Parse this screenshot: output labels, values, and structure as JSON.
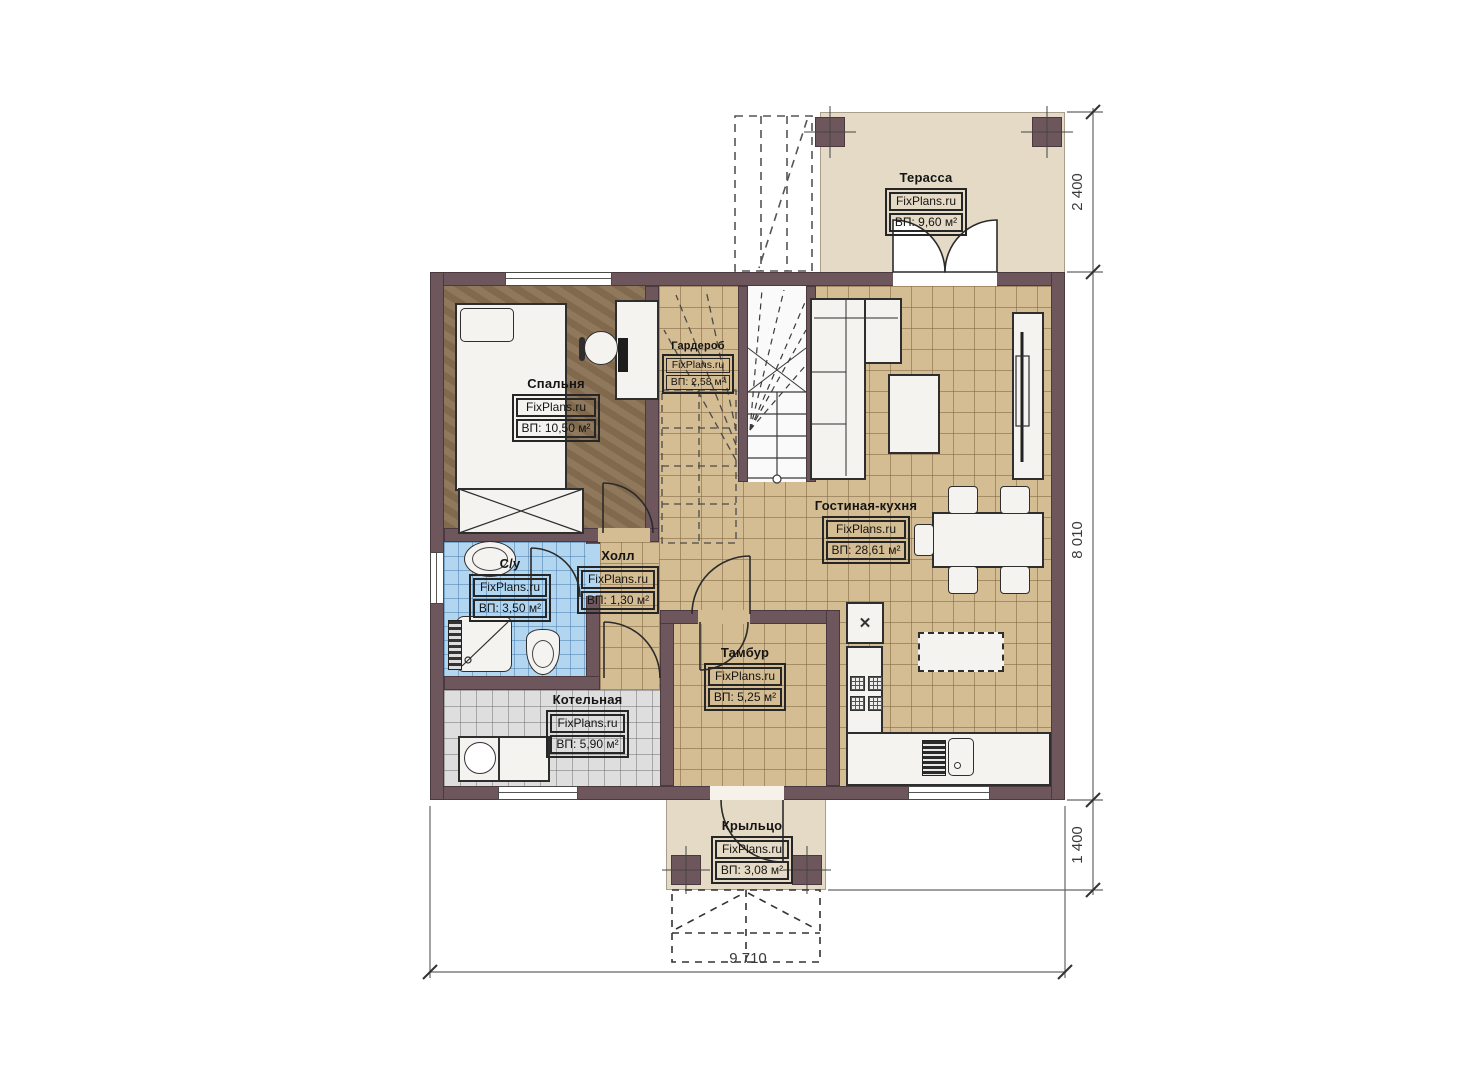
{
  "brand": "FixPlans.ru",
  "icons": {
    "appliance_cross": "✕"
  },
  "rooms": {
    "terrace": {
      "name": "Терасса",
      "area": "ВП: 9,60 м²"
    },
    "bedroom": {
      "name": "Спальня",
      "area": "ВП: 10,50 м²"
    },
    "wardrobe": {
      "name": "Гардероб",
      "area": "ВП: 2,58 м²"
    },
    "living_kitchen": {
      "name": "Гостиная-кухня",
      "area": "ВП: 28,61 м²"
    },
    "hall": {
      "name": "Холл",
      "area": "ВП: 1,30 м²"
    },
    "bathroom": {
      "name": "С/у",
      "area": "ВП: 3,50 м²"
    },
    "boiler": {
      "name": "Котельная",
      "area": "ВП: 5,90 м²"
    },
    "vestibule": {
      "name": "Тамбур",
      "area": "ВП: 5,25 м²"
    },
    "porch": {
      "name": "Крыльцо",
      "area": "ВП: 3,08 м²"
    }
  },
  "dimensions": {
    "terrace_depth": "2 400",
    "house_depth": "8 010",
    "porch_depth": "1 400",
    "house_width": "9 710"
  },
  "colors": {
    "wall": "#6e575c",
    "tile_tan": "#d4bc93",
    "tile_blue": "#b3d6f0",
    "tile_gray": "#dedede",
    "bedroom_floor": "#8a7153",
    "outdoor": "#e5dac5"
  }
}
